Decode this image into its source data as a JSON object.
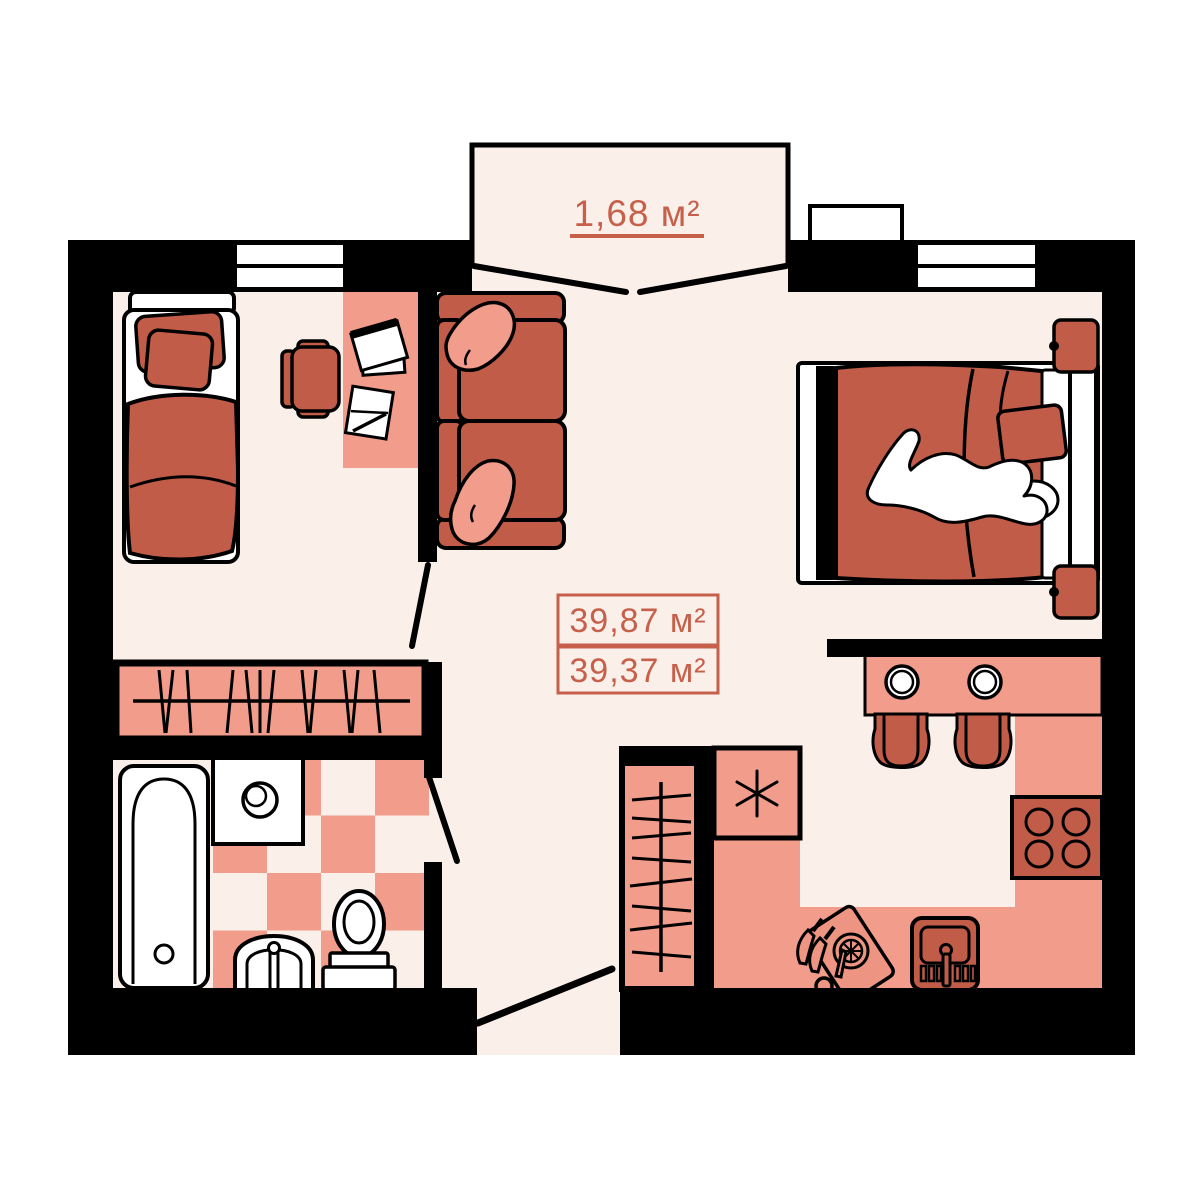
{
  "plan": {
    "balcony_label": "1,68 м²",
    "area_total_label": "39,87 м²",
    "area_living_label": "39,37 м²"
  },
  "colors": {
    "background": "#FFFFFF",
    "floor": "#FBEFEA",
    "walls": "#000000",
    "furniture_light": "#F29C8B",
    "furniture_dark": "#C15C49",
    "accent_text": "#C6604B",
    "fixtures": "#FFFFFF"
  },
  "icons": [
    "single-bed",
    "desk",
    "desk-chair",
    "paper-sheets",
    "pen",
    "sofa",
    "sofa-pillows",
    "balcony-doors",
    "window",
    "air-conditioner",
    "double-bed",
    "sleeping-person",
    "bed-pillow",
    "nightstand",
    "wardrobe-hangers",
    "closet-hangers",
    "checkered-tile-floor",
    "bathtub",
    "washing-machine",
    "washbasin",
    "toilet",
    "fridge-snowflake",
    "dining-table",
    "plates",
    "dining-chairs",
    "stove-burners",
    "kitchen-sink",
    "cutting-board",
    "lemon-slice",
    "knives",
    "door-swing"
  ]
}
